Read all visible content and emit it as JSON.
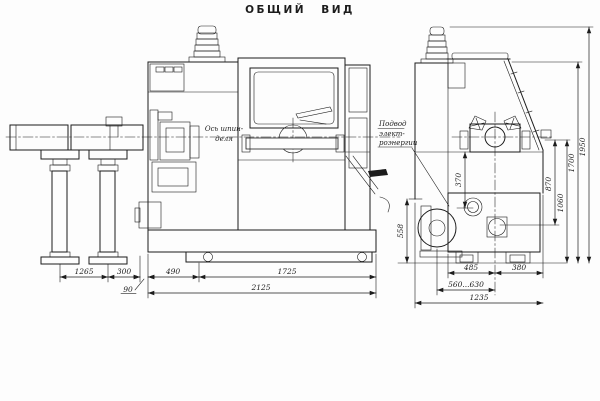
{
  "title": "ОБЩИЙ ВИД",
  "labels": {
    "spindle_axis": [
      "Ось шпин-",
      "деля"
    ],
    "power_supply": [
      "Подвод",
      "элект-",
      "роэнергии"
    ]
  },
  "dimensions": {
    "feeder_span": "1265",
    "feeder_to_machine": "300",
    "overhang": "90",
    "left_section": "490",
    "bed_length": "1725",
    "overall_length": "2125",
    "side_front_to_axis": "485",
    "side_axis_to_back": "380",
    "side_adjustable": "560...630",
    "side_overall_width": "1235",
    "v_370": "370",
    "v_870": "870",
    "v_1060": "1060",
    "v_1700": "1700",
    "v_1950": "1950",
    "v_558": "558"
  },
  "colors": {
    "ink": "#1c1c1c",
    "paper": "#fdfdfd"
  }
}
